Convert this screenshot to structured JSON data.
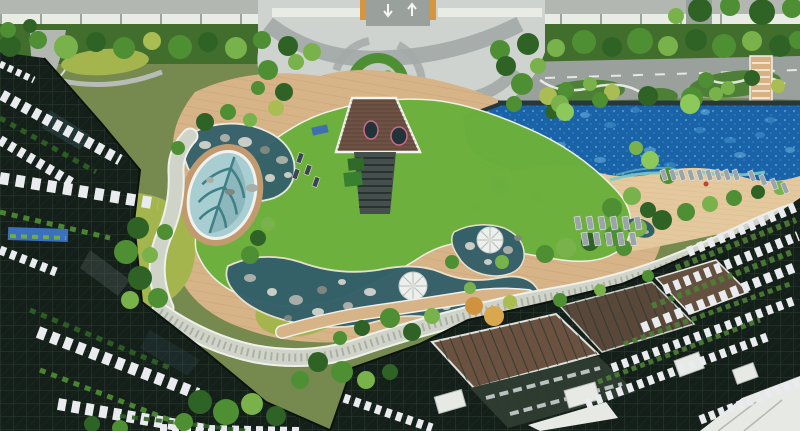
{
  "palette": {
    "base_green": "#76894f",
    "road_gray": "#b3b7b1",
    "road_dark": "#9aa09c",
    "wall_white": "#e9ebe5",
    "plaza_light": "#cfd3cf",
    "plaza_swirl": "#a2a9a6",
    "hedge_base": "#426e2d",
    "tree_dark": "#2f6326",
    "tree_mid": "#4f8f33",
    "tree_light": "#79b24a",
    "tree_yellow": "#a9bd52",
    "tree_orange": "#cf9340",
    "tree_orange2": "#d9a84e",
    "palm_green": "#8cc85a",
    "pool_deep": "#1a63a8",
    "pool_light": "#4d9fd6",
    "pool_pale": "#7fc6e8",
    "pool_rim": "#24383e",
    "pool_steps": "#7ccac2",
    "spa_teal": "#5fb5ae",
    "spa_ring": "#c2e2da",
    "sand": "#e4c89e",
    "wood": "#d7b388",
    "wood_line": "#c29a70",
    "lawn": "#6cb03c",
    "lawn_yellow": "#a5b54e",
    "pond": "#335f6a",
    "pond_leaf": "#a9ced2",
    "leaf_vein": "#3f7f86",
    "rock_light": "#c9cdc6",
    "rock_mid": "#a8aea7",
    "rock_dark": "#7f877f",
    "pebble": "#d0d3c8",
    "pebble_dot": "#939a8f",
    "bldg_dark": "#151f1a",
    "bldg_grid": "#2c4132",
    "slab_white": "#e9ebee",
    "roof_brown": "#6e5244",
    "stair_dark": "#454f4b",
    "dome_white": "#ecefec",
    "dome_line": "#b7bcb7",
    "trellis_brown": "#6b5140",
    "trellis_dark": "#2e3b31",
    "box_white": "#e7e9e5",
    "gate_orange": "#d8953f",
    "mural_blue": "#3a70be",
    "planter_green": "#4e7f36",
    "lounger": "#9ba5a9",
    "lounger_dark": "#3c464e",
    "umbrella_red": "#c04634"
  },
  "scene": {
    "trees": [
      [
        10,
        46,
        11,
        "tree_dark"
      ],
      [
        38,
        40,
        9,
        "tree_mid"
      ],
      [
        66,
        47,
        12,
        "tree_light"
      ],
      [
        96,
        42,
        10,
        "tree_dark"
      ],
      [
        124,
        48,
        11,
        "tree_mid"
      ],
      [
        152,
        41,
        9,
        "tree_yellow"
      ],
      [
        180,
        47,
        12,
        "tree_mid"
      ],
      [
        208,
        42,
        10,
        "tree_dark"
      ],
      [
        236,
        48,
        11,
        "tree_light"
      ],
      [
        262,
        40,
        9,
        "tree_mid"
      ],
      [
        288,
        46,
        10,
        "tree_dark"
      ],
      [
        312,
        52,
        9,
        "tree_light"
      ],
      [
        500,
        50,
        10,
        "tree_mid"
      ],
      [
        528,
        44,
        11,
        "tree_dark"
      ],
      [
        556,
        48,
        9,
        "tree_light"
      ],
      [
        584,
        42,
        12,
        "tree_mid"
      ],
      [
        612,
        47,
        10,
        "tree_dark"
      ],
      [
        640,
        41,
        13,
        "tree_mid"
      ],
      [
        668,
        46,
        10,
        "tree_light"
      ],
      [
        696,
        40,
        11,
        "tree_dark"
      ],
      [
        724,
        46,
        12,
        "tree_mid"
      ],
      [
        752,
        41,
        10,
        "tree_light"
      ],
      [
        780,
        46,
        11,
        "tree_dark"
      ],
      [
        798,
        40,
        9,
        "tree_mid"
      ],
      [
        700,
        10,
        12,
        "tree_dark"
      ],
      [
        730,
        6,
        10,
        "tree_mid"
      ],
      [
        762,
        12,
        13,
        "tree_dark"
      ],
      [
        792,
        8,
        10,
        "tree_mid"
      ],
      [
        676,
        16,
        8,
        "tree_light"
      ],
      [
        8,
        30,
        8,
        "tree_mid"
      ],
      [
        30,
        26,
        7,
        "tree_dark"
      ],
      [
        268,
        70,
        10,
        "tree_mid"
      ],
      [
        284,
        92,
        9,
        "tree_dark"
      ],
      [
        296,
        62,
        8,
        "tree_light"
      ],
      [
        276,
        108,
        8,
        "tree_yellow"
      ],
      [
        258,
        88,
        7,
        "tree_mid"
      ],
      [
        506,
        66,
        10,
        "tree_dark"
      ],
      [
        522,
        84,
        11,
        "tree_mid"
      ],
      [
        538,
        66,
        8,
        "tree_light"
      ],
      [
        548,
        96,
        9,
        "tree_yellow"
      ],
      [
        514,
        104,
        8,
        "tree_mid"
      ],
      [
        552,
        112,
        7,
        "tree_dark"
      ],
      [
        566,
        90,
        8,
        "tree_mid"
      ],
      [
        590,
        84,
        7,
        "tree_light"
      ],
      [
        612,
        92,
        8,
        "tree_yellow"
      ],
      [
        706,
        80,
        8,
        "tree_mid"
      ],
      [
        728,
        88,
        7,
        "tree_light"
      ],
      [
        752,
        78,
        8,
        "tree_dark"
      ],
      [
        778,
        86,
        7,
        "tree_yellow"
      ],
      [
        560,
        104,
        9,
        "tree_light"
      ],
      [
        600,
        100,
        8,
        "tree_mid"
      ],
      [
        648,
        96,
        10,
        "tree_dark"
      ],
      [
        692,
        98,
        11,
        "tree_mid"
      ],
      [
        716,
        94,
        7,
        "tree_light"
      ],
      [
        565,
        112,
        9,
        "palm_green"
      ],
      [
        690,
        104,
        10,
        "palm_green"
      ],
      [
        205,
        122,
        9,
        "tree_dark"
      ],
      [
        228,
        112,
        8,
        "tree_mid"
      ],
      [
        250,
        120,
        7,
        "tree_light"
      ],
      [
        138,
        228,
        11,
        "tree_dark"
      ],
      [
        126,
        252,
        12,
        "tree_mid"
      ],
      [
        140,
        278,
        12,
        "tree_dark"
      ],
      [
        158,
        298,
        10,
        "tree_mid"
      ],
      [
        130,
        300,
        9,
        "tree_light"
      ],
      [
        150,
        255,
        8,
        "tree_light"
      ],
      [
        165,
        232,
        8,
        "tree_mid"
      ],
      [
        178,
        148,
        7,
        "tree_mid"
      ],
      [
        258,
        238,
        8,
        "tree_dark"
      ],
      [
        250,
        255,
        9,
        "tree_mid"
      ],
      [
        268,
        224,
        7,
        "tree_light"
      ],
      [
        390,
        318,
        10,
        "tree_mid"
      ],
      [
        412,
        332,
        9,
        "tree_dark"
      ],
      [
        432,
        316,
        8,
        "tree_light"
      ],
      [
        362,
        328,
        8,
        "tree_dark"
      ],
      [
        340,
        338,
        7,
        "tree_mid"
      ],
      [
        318,
        362,
        10,
        "tree_dark"
      ],
      [
        342,
        372,
        11,
        "tree_mid"
      ],
      [
        366,
        380,
        9,
        "tree_light"
      ],
      [
        390,
        372,
        8,
        "tree_dark"
      ],
      [
        300,
        380,
        9,
        "tree_mid"
      ],
      [
        474,
        306,
        9,
        "tree_orange"
      ],
      [
        494,
        316,
        10,
        "tree_orange2"
      ],
      [
        510,
        302,
        7,
        "tree_yellow"
      ],
      [
        545,
        254,
        9,
        "tree_mid"
      ],
      [
        566,
        248,
        10,
        "tree_light"
      ],
      [
        590,
        242,
        9,
        "tree_dark"
      ],
      [
        614,
        236,
        10,
        "tree_mid"
      ],
      [
        638,
        228,
        9,
        "tree_light"
      ],
      [
        662,
        220,
        10,
        "tree_dark"
      ],
      [
        686,
        212,
        9,
        "tree_mid"
      ],
      [
        710,
        204,
        8,
        "tree_light"
      ],
      [
        734,
        198,
        8,
        "tree_mid"
      ],
      [
        758,
        192,
        7,
        "tree_dark"
      ],
      [
        780,
        188,
        7,
        "tree_light"
      ],
      [
        612,
        208,
        10,
        "tree_mid"
      ],
      [
        632,
        196,
        9,
        "tree_light"
      ],
      [
        648,
        210,
        8,
        "tree_dark"
      ],
      [
        624,
        248,
        8,
        "tree_mid"
      ],
      [
        650,
        160,
        9,
        "palm_green"
      ],
      [
        668,
        176,
        8,
        "tree_mid"
      ],
      [
        636,
        148,
        7,
        "tree_light"
      ],
      [
        452,
        262,
        7,
        "tree_mid"
      ],
      [
        502,
        262,
        7,
        "tree_light"
      ],
      [
        470,
        288,
        6,
        "tree_light"
      ],
      [
        200,
        402,
        12,
        "tree_dark"
      ],
      [
        226,
        412,
        13,
        "tree_mid"
      ],
      [
        252,
        404,
        11,
        "tree_light"
      ],
      [
        276,
        416,
        10,
        "tree_dark"
      ],
      [
        184,
        422,
        9,
        "tree_mid"
      ],
      [
        92,
        424,
        8,
        "tree_dark"
      ],
      [
        120,
        428,
        8,
        "tree_mid"
      ],
      [
        560,
        300,
        7,
        "tree_mid"
      ],
      [
        600,
        290,
        6,
        "tree_light"
      ],
      [
        648,
        276,
        6,
        "tree_mid"
      ]
    ],
    "rocks": [
      [
        205,
        145,
        6,
        4,
        "rock_light"
      ],
      [
        225,
        138,
        5,
        4,
        "rock_mid"
      ],
      [
        245,
        142,
        7,
        5,
        "rock_light"
      ],
      [
        265,
        150,
        5,
        4,
        "rock_dark"
      ],
      [
        282,
        160,
        6,
        4,
        "rock_mid"
      ],
      [
        270,
        178,
        5,
        4,
        "rock_light"
      ],
      [
        252,
        188,
        6,
        4,
        "rock_mid"
      ],
      [
        230,
        192,
        5,
        3,
        "rock_dark"
      ],
      [
        210,
        180,
        4,
        3,
        "rock_mid"
      ],
      [
        288,
        175,
        4,
        3,
        "rock_light"
      ],
      [
        250,
        278,
        6,
        4,
        "rock_mid"
      ],
      [
        272,
        292,
        5,
        4,
        "rock_light"
      ],
      [
        296,
        300,
        7,
        5,
        "rock_mid"
      ],
      [
        322,
        290,
        5,
        4,
        "rock_dark"
      ],
      [
        318,
        312,
        6,
        4,
        "rock_light"
      ],
      [
        348,
        306,
        5,
        4,
        "rock_mid"
      ],
      [
        370,
        292,
        6,
        4,
        "rock_light"
      ],
      [
        398,
        306,
        5,
        4,
        "rock_mid"
      ],
      [
        424,
        300,
        4,
        3,
        "rock_dark"
      ],
      [
        446,
        306,
        5,
        4,
        "rock_light"
      ],
      [
        466,
        296,
        4,
        3,
        "rock_mid"
      ],
      [
        342,
        282,
        4,
        3,
        "rock_light"
      ],
      [
        288,
        318,
        4,
        3,
        "rock_dark"
      ],
      [
        470,
        246,
        5,
        4,
        "rock_light"
      ],
      [
        508,
        250,
        5,
        4,
        "rock_mid"
      ],
      [
        488,
        262,
        4,
        3,
        "rock_light"
      ],
      [
        518,
        238,
        4,
        3,
        "rock_dark"
      ],
      [
        636,
        226,
        4,
        3,
        "rock_light"
      ],
      [
        646,
        232,
        3,
        2,
        "rock_mid"
      ]
    ],
    "loungers": [
      [
        578,
        223,
        6,
        13,
        -10,
        "lounger"
      ],
      [
        590,
        223,
        6,
        13,
        -10,
        "lounger"
      ],
      [
        602,
        223,
        6,
        13,
        -10,
        "lounger"
      ],
      [
        614,
        223,
        6,
        13,
        -10,
        "lounger"
      ],
      [
        626,
        223,
        6,
        13,
        -10,
        "lounger"
      ],
      [
        638,
        223,
        6,
        13,
        -10,
        "lounger"
      ],
      [
        585,
        239,
        6,
        13,
        -10,
        "lounger"
      ],
      [
        597,
        239,
        6,
        13,
        -10,
        "lounger"
      ],
      [
        609,
        239,
        6,
        13,
        -10,
        "lounger"
      ],
      [
        621,
        239,
        6,
        13,
        -10,
        "lounger"
      ],
      [
        633,
        239,
        6,
        13,
        -10,
        "lounger"
      ],
      [
        664,
        175,
        5,
        11,
        -18,
        "lounger"
      ],
      [
        673,
        175,
        5,
        11,
        -18,
        "lounger"
      ],
      [
        682,
        175,
        5,
        11,
        -18,
        "lounger"
      ],
      [
        691,
        175,
        5,
        11,
        -18,
        "lounger"
      ],
      [
        700,
        175,
        5,
        11,
        -18,
        "lounger"
      ],
      [
        709,
        175,
        5,
        11,
        -18,
        "lounger"
      ],
      [
        718,
        175,
        5,
        11,
        -18,
        "lounger"
      ],
      [
        727,
        175,
        5,
        11,
        -18,
        "lounger"
      ],
      [
        736,
        175,
        5,
        11,
        -18,
        "lounger"
      ],
      [
        752,
        176,
        5,
        11,
        -22,
        "lounger"
      ],
      [
        763,
        180,
        5,
        11,
        -22,
        "lounger"
      ],
      [
        774,
        184,
        5,
        11,
        -22,
        "lounger"
      ],
      [
        785,
        188,
        5,
        11,
        -22,
        "lounger"
      ],
      [
        300,
        158,
        5,
        10,
        20,
        "lounger_dark"
      ],
      [
        308,
        170,
        5,
        10,
        20,
        "lounger_dark"
      ],
      [
        316,
        182,
        5,
        10,
        20,
        "lounger_dark"
      ],
      [
        296,
        174,
        5,
        10,
        20,
        "lounger_dark"
      ]
    ],
    "balcony_rows": [
      [
        2,
        95,
        120,
        160,
        11,
        "7 5"
      ],
      [
        0,
        140,
        74,
        184,
        10,
        "6 5"
      ],
      [
        0,
        178,
        158,
        204,
        12,
        "9 7"
      ],
      [
        0,
        250,
        56,
        272,
        9,
        "6 5"
      ],
      [
        38,
        332,
        198,
        394,
        12,
        "8 6"
      ],
      [
        58,
        404,
        206,
        430,
        12,
        "8 6"
      ],
      [
        160,
        428,
        300,
        431,
        8,
        "7 5"
      ],
      [
        0,
        64,
        34,
        80,
        7,
        "5 4"
      ],
      [
        688,
        252,
        798,
        206,
        10,
        "6 5"
      ],
      [
        664,
        290,
        798,
        236,
        10,
        "6 5"
      ],
      [
        642,
        328,
        798,
        266,
        10,
        "7 5"
      ],
      [
        612,
        368,
        796,
        300,
        9,
        "6 5"
      ],
      [
        586,
        404,
        770,
        336,
        9,
        "6 5"
      ],
      [
        700,
        420,
        800,
        382,
        9,
        "6 4"
      ],
      [
        344,
        398,
        432,
        428,
        9,
        "6 5"
      ]
    ],
    "planter_rows": [
      [
        676,
        268,
        796,
        220,
        6,
        "5 4",
        "planter_green"
      ],
      [
        652,
        306,
        792,
        252,
        6,
        "5 4",
        "planter_green"
      ],
      [
        624,
        344,
        790,
        284,
        5,
        "5 4",
        "planter_green"
      ],
      [
        598,
        382,
        760,
        320,
        5,
        "5 4",
        "planter_green"
      ],
      [
        0,
        118,
        96,
        172,
        5,
        "6 6",
        "tree_dark"
      ],
      [
        0,
        212,
        110,
        238,
        5,
        "6 6",
        "tree_mid"
      ],
      [
        30,
        310,
        170,
        368,
        5,
        "6 6",
        "tree_dark"
      ],
      [
        40,
        370,
        180,
        424,
        5,
        "6 6",
        "tree_mid"
      ],
      [
        120,
        416,
        248,
        431,
        4,
        "6 6",
        "tree_dark"
      ]
    ],
    "pool_sparkles": [
      [
        520,
        130,
        6,
        3,
        "pool_light"
      ],
      [
        560,
        145,
        6,
        3,
        "pool_pale"
      ],
      [
        610,
        125,
        6,
        3,
        "pool_light"
      ],
      [
        650,
        150,
        6,
        3,
        "pool_pale"
      ],
      [
        700,
        130,
        6,
        3,
        "pool_light"
      ],
      [
        740,
        155,
        6,
        3,
        "pool_pale"
      ],
      [
        770,
        120,
        6,
        3,
        "pool_light"
      ],
      [
        600,
        160,
        6,
        3,
        "pool_pale"
      ],
      [
        670,
        165,
        6,
        3,
        "pool_light"
      ],
      [
        730,
        140,
        6,
        3,
        "pool_light"
      ],
      [
        790,
        150,
        5,
        3,
        "pool_pale"
      ],
      [
        540,
        160,
        5,
        3,
        "pool_light"
      ],
      [
        585,
        115,
        5,
        3,
        "pool_pale"
      ],
      [
        635,
        110,
        5,
        3,
        "pool_light"
      ],
      [
        705,
        112,
        5,
        3,
        "pool_pale"
      ],
      [
        760,
        135,
        5,
        3,
        "pool_light"
      ]
    ]
  }
}
